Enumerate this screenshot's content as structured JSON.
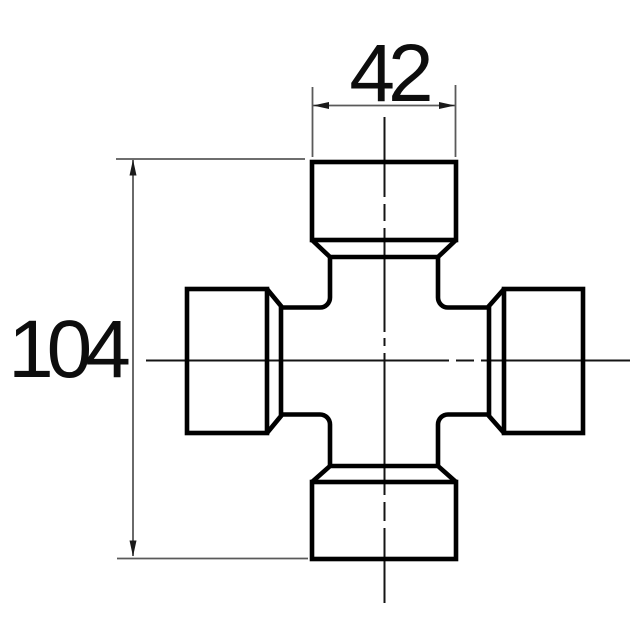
{
  "drawing": {
    "type": "engineering-drawing-universal-joint-cross",
    "dimensions": {
      "cap_width": {
        "label": "42"
      },
      "overall_height": {
        "label": "104"
      }
    },
    "colors": {
      "part_outline": "#000000",
      "centerline": "#141414",
      "dimension_lines": "#5a5a5a",
      "background": "#ffffff"
    }
  }
}
